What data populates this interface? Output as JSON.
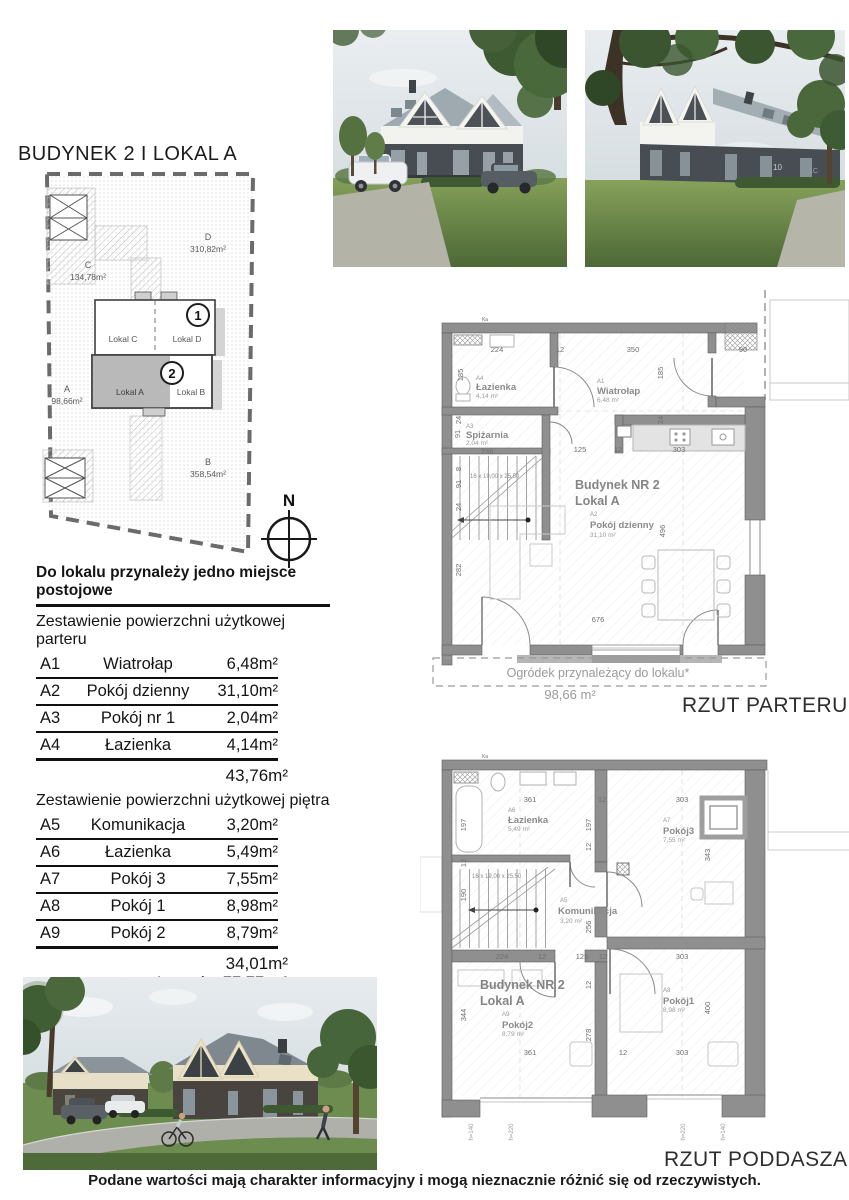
{
  "page": {
    "title": "BUDYNEK 2 I LOKAL A",
    "parking_note": "Do lokalu przynależy jedno miejsce postojowe",
    "disclaimer": "Podane wartości mają charakter informacyjny i mogą nieznacznie różnić się od rzeczywistych."
  },
  "site_plan": {
    "plots": [
      {
        "label": "A",
        "area": "98,66m²"
      },
      {
        "label": "B",
        "area": "358,54m²"
      },
      {
        "label": "C",
        "area": "134,78m²"
      },
      {
        "label": "D",
        "area": "310,82m²"
      }
    ],
    "building_1": {
      "badge": "1",
      "unit_left": "Lokal C",
      "unit_right": "Lokal D"
    },
    "building_2": {
      "badge": "2",
      "unit_left": "Lokal A",
      "unit_right": "Lokal B"
    },
    "compass": "N"
  },
  "area_tables": {
    "ground": {
      "header": "Zestawienie powierzchni użytkowej parteru",
      "rows": [
        {
          "id": "A1",
          "name": "Wiatrołap",
          "area": "6,48m²"
        },
        {
          "id": "A2",
          "name": "Pokój dzienny",
          "area": "31,10m²"
        },
        {
          "id": "A3",
          "name": "Pokój nr 1",
          "area": "2,04m²"
        },
        {
          "id": "A4",
          "name": "Łazienka",
          "area": "4,14m²"
        }
      ],
      "subtotal": "43,76m²"
    },
    "upper": {
      "header": "Zestawienie powierzchni użytkowej piętra",
      "rows": [
        {
          "id": "A5",
          "name": "Komunikacja",
          "area": "3,20m²"
        },
        {
          "id": "A6",
          "name": "Łazienka",
          "area": "5,49m²"
        },
        {
          "id": "A7",
          "name": "Pokój 3",
          "area": "7,55m²"
        },
        {
          "id": "A8",
          "name": "Pokój 1",
          "area": "8,98m²"
        },
        {
          "id": "A9",
          "name": "Pokój 2",
          "area": "8,79m²"
        }
      ],
      "subtotal": "34,01m²",
      "total_label": "Łącznie",
      "total": "77,77 m²"
    },
    "garden": {
      "label_line1": "Ogródek*",
      "label_line2": "przynależący do lokalu*",
      "area": "98,66 m²"
    }
  },
  "ground_plan": {
    "caption": "RZUT PARTERU",
    "marker": "Ka",
    "building_label": "Budynek NR 2",
    "unit_label": "Lokal A",
    "rooms": {
      "bathroom": {
        "id": "A4",
        "name": "Łazienka",
        "area": "4,14 m²"
      },
      "entry": {
        "id": "A1",
        "name": "Wiatrołap",
        "area": "6,48 m²"
      },
      "pantry": {
        "id": "A3",
        "name": "Spiżarnia",
        "area": "2,04 m²"
      },
      "living": {
        "id": "A2",
        "name": "Pokój dzienny",
        "area": "31,10 m²"
      }
    },
    "stairs_note": "16 x 19,00 x 25,50",
    "garden_label": "Ogródek przynależący do lokalu*",
    "garden_area": "98,66 m²",
    "dims": {
      "top": [
        "224",
        "12",
        "350",
        "90"
      ],
      "left": [
        "185",
        "24",
        "91",
        "8",
        "91",
        "24",
        "282"
      ],
      "inner": [
        "236",
        "125",
        "12",
        "303"
      ],
      "right": [
        "185",
        "24",
        "496"
      ],
      "bottom": [
        "676"
      ]
    }
  },
  "attic_plan": {
    "caption": "RZUT PODDASZA",
    "marker": "Ka",
    "building_label": "Budynek NR 2",
    "unit_label": "Lokal A",
    "rooms": {
      "bathroom": {
        "id": "A6",
        "name": "Łazienka",
        "area": "5,49 m²"
      },
      "room3": {
        "id": "A7",
        "name": "Pokój3",
        "area": "7,55 m²"
      },
      "hall": {
        "id": "A5",
        "name": "Komunikacja",
        "area": "3,20 m²"
      },
      "room2": {
        "id": "A9",
        "name": "Pokój2",
        "area": "8,79 m²"
      },
      "room1": {
        "id": "A8",
        "name": "Pokój1",
        "area": "8,98 m²"
      }
    },
    "stairs_note": "16 x 19,00 x 25,50",
    "dims": {
      "top": [
        "361",
        "12",
        "303"
      ],
      "left": [
        "197",
        "12",
        "190",
        "344"
      ],
      "middle": [
        "197",
        "12",
        "256",
        "12",
        "278"
      ],
      "mid_chain": [
        "224",
        "12",
        "125",
        "12",
        "303"
      ],
      "right": [
        "343",
        "400"
      ],
      "bottom": [
        "361",
        "12",
        "303"
      ],
      "sills": [
        "h=140",
        "h=220",
        "h=220",
        "h=140"
      ]
    }
  },
  "photos": {
    "wall_numbers": [
      "10",
      "1C"
    ]
  }
}
